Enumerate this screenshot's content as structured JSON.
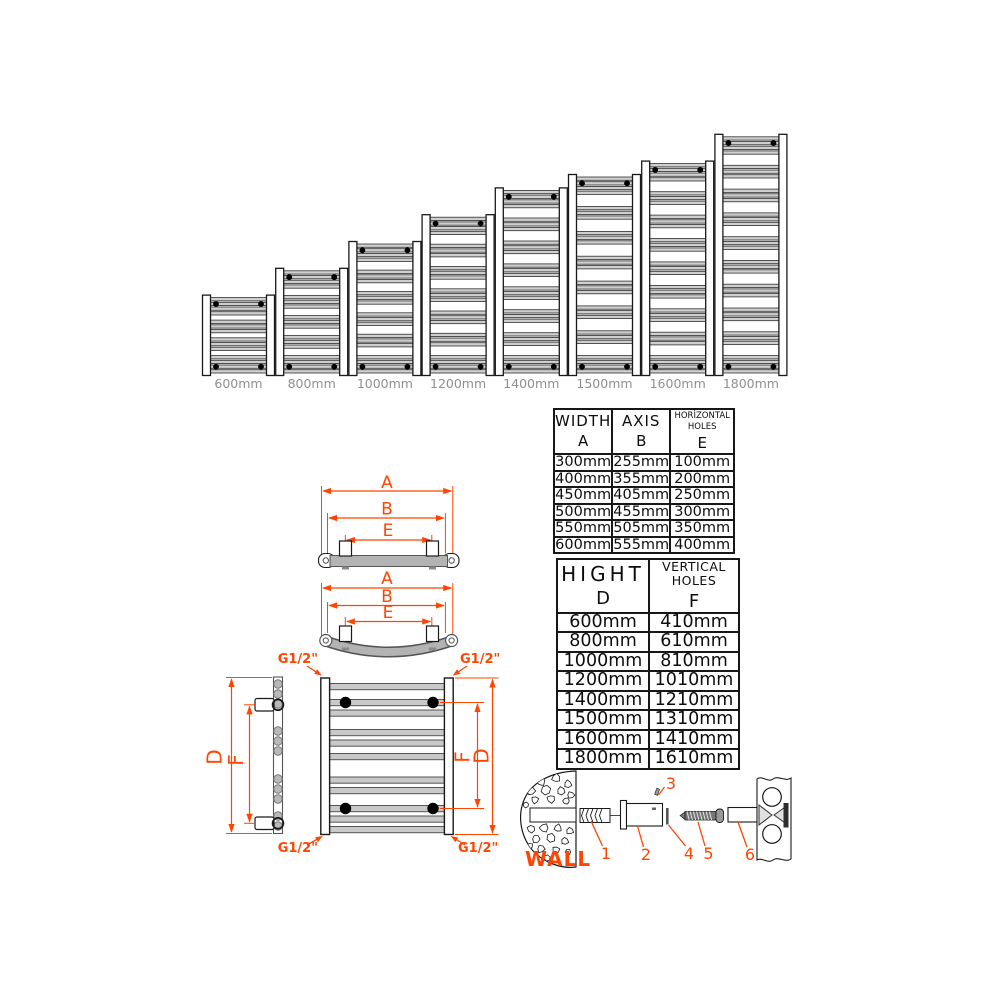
{
  "colors": {
    "accent": "#ff4500",
    "label_gray": "#8f8f8f",
    "rung_fill": "#cfcfcf",
    "rung_stroke": "#2f2f2f",
    "rail_gray": "#b3b3b3",
    "outline": "#1a1a1a"
  },
  "lineup": {
    "items": [
      {
        "label": "600mm",
        "height_mm": 600
      },
      {
        "label": "800mm",
        "height_mm": 800
      },
      {
        "label": "1000mm",
        "height_mm": 1000
      },
      {
        "label": "1200mm",
        "height_mm": 1200
      },
      {
        "label": "1400mm",
        "height_mm": 1400
      },
      {
        "label": "1500mm",
        "height_mm": 1500
      },
      {
        "label": "1600mm",
        "height_mm": 1600
      },
      {
        "label": "1800mm",
        "height_mm": 1800
      }
    ]
  },
  "width_table": {
    "columns": [
      {
        "title_lines": [
          "WIDTH"
        ],
        "letter": "A"
      },
      {
        "title_lines": [
          "AXIS"
        ],
        "letter": "B"
      },
      {
        "title_lines": [
          "HORİZONTAL",
          "HOLES"
        ],
        "letter": "E"
      }
    ],
    "rows": [
      [
        "300mm",
        "255mm",
        "100mm"
      ],
      [
        "400mm",
        "355mm",
        "200mm"
      ],
      [
        "450mm",
        "405mm",
        "250mm"
      ],
      [
        "500mm",
        "455mm",
        "300mm"
      ],
      [
        "550mm",
        "505mm",
        "350mm"
      ],
      [
        "600mm",
        "555mm",
        "400mm"
      ]
    ]
  },
  "height_table": {
    "columns": [
      {
        "title_lines": [
          "HIGHT"
        ],
        "letter": "D"
      },
      {
        "title_lines": [
          "VERTICAL",
          "HOLES"
        ],
        "letter": "F"
      }
    ],
    "rows": [
      [
        "600mm",
        "410mm"
      ],
      [
        "800mm",
        "610mm"
      ],
      [
        "1000mm",
        "810mm"
      ],
      [
        "1200mm",
        "1010mm"
      ],
      [
        "1400mm",
        "1210mm"
      ],
      [
        "1500mm",
        "1310mm"
      ],
      [
        "1600mm",
        "1410mm"
      ],
      [
        "1800mm",
        "1610mm"
      ]
    ]
  },
  "dims": {
    "width_letter": "A",
    "axis_letter": "B",
    "horizontal_holes_letter": "E",
    "height_letter": "D",
    "vertical_holes_letter": "F",
    "connection": "G1/2\""
  },
  "mounting": {
    "wall_label": "WALL",
    "part_numbers": [
      "1",
      "2",
      "3",
      "4",
      "5",
      "6"
    ]
  }
}
